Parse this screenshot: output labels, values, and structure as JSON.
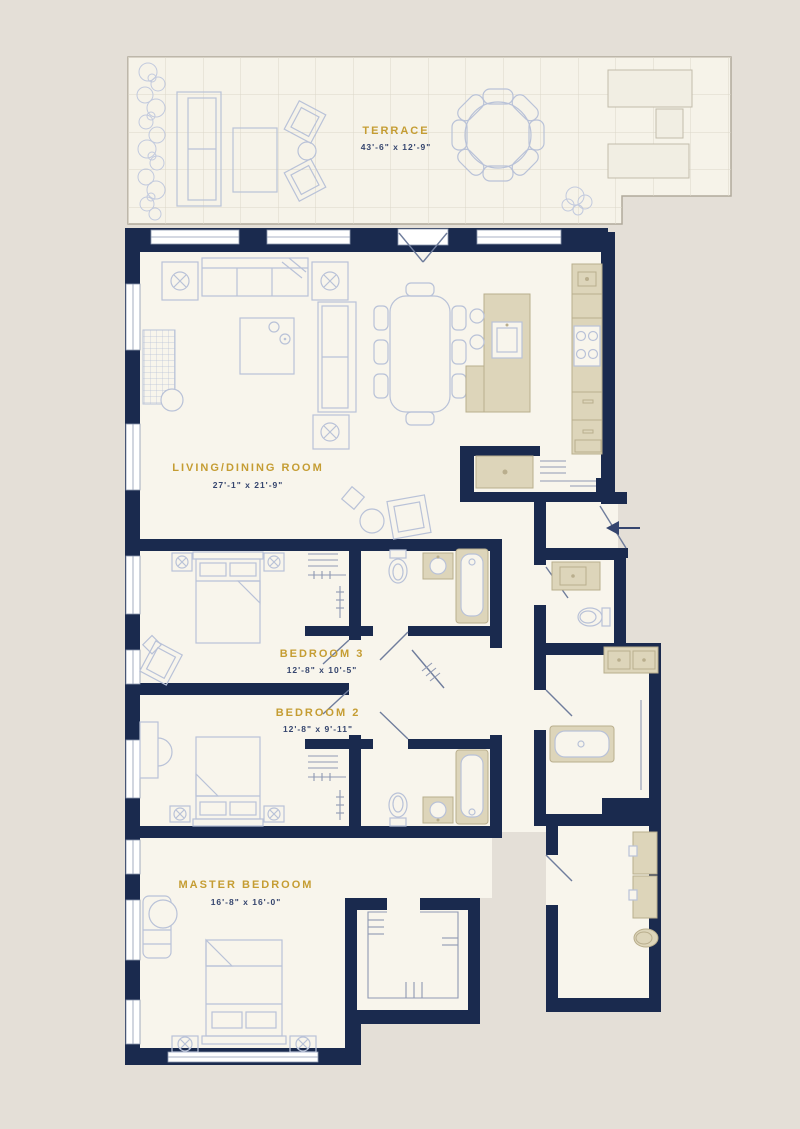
{
  "plan": {
    "type": "residential-floor-plan",
    "rooms": [
      {
        "id": "terrace",
        "name": "TERRACE",
        "dims": "43'-6\" x 12'-9\""
      },
      {
        "id": "living-dining",
        "name": "LIVING/DINING ROOM",
        "dims": "27'-1\" x 21'-9\""
      },
      {
        "id": "bedroom-3",
        "name": "BEDROOM 3",
        "dims": "12'-8\" x 10'-5\""
      },
      {
        "id": "bedroom-2",
        "name": "BEDROOM 2",
        "dims": "12'-8\" x 9'-11\""
      },
      {
        "id": "master-bedroom",
        "name": "MASTER BEDROOM",
        "dims": "16'-8\" x 16'-0\""
      }
    ],
    "palette": {
      "background": "#e4dfd7",
      "floor": "#f8f5ec",
      "wall": "#1a2a4e",
      "furniture_line": "#b9c2d8",
      "fixture_fill": "#ddd5ba",
      "label_gold": "#c59d33",
      "label_navy": "#35456e"
    },
    "icons": {
      "entry_arrow": "entry direction arrow"
    }
  }
}
